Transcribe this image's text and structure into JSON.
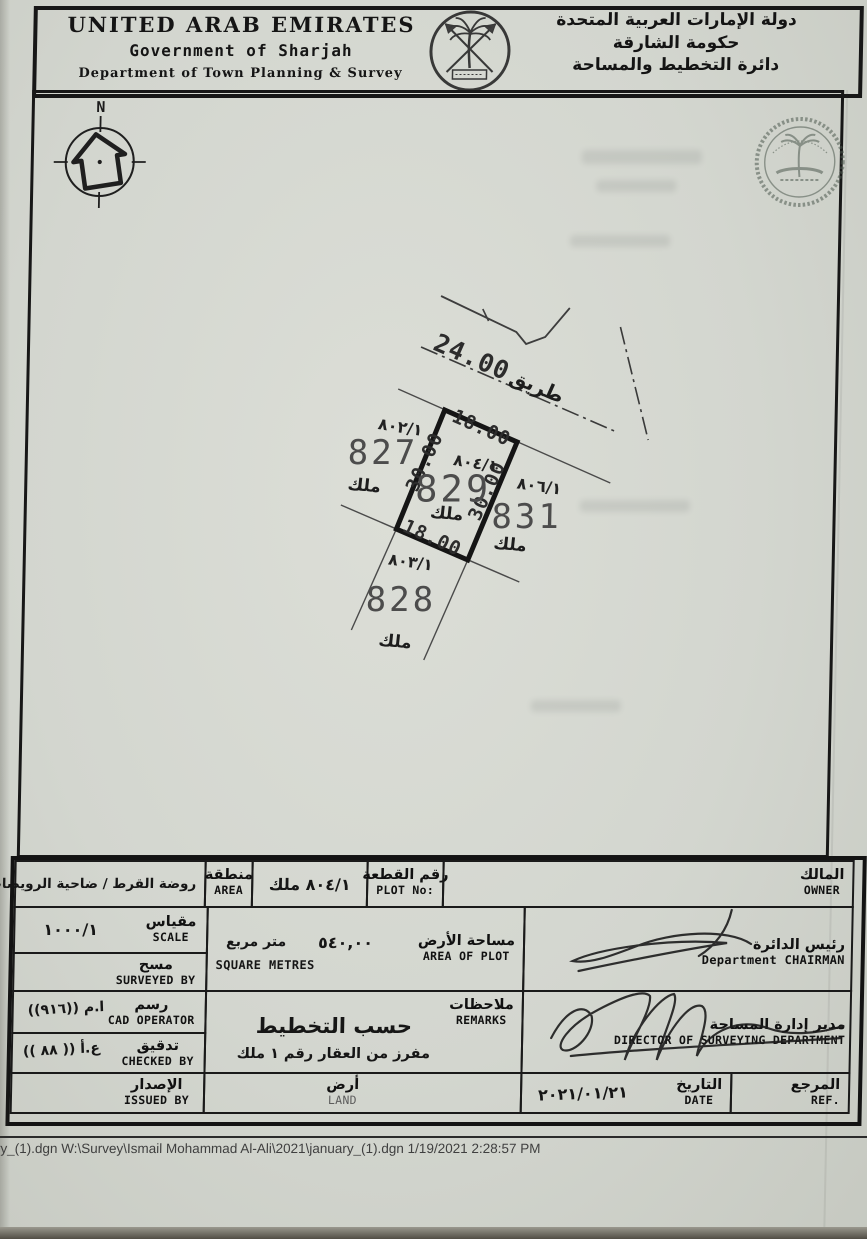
{
  "header": {
    "en1": "UNITED ARAB EMIRATES",
    "en2": "Government of Sharjah",
    "en3": "Department of Town Planning &  Survey",
    "ar1": "دولة الإمارات العربية المتحدة",
    "ar2": "حكومة الشارقة",
    "ar3": "دائرة التخطيط والمساحة"
  },
  "map": {
    "north": "N",
    "road_width": "24.00",
    "road_name": "طريق",
    "plot_center": {
      "parcel": "٨٠٤/١",
      "number": "829",
      "tenure": "ملك",
      "dim_top": "18.00",
      "dim_left": "30.00",
      "dim_right": "30.00",
      "dim_bottom": "18.00"
    },
    "plot_left": {
      "parcel": "٨٠٢/١",
      "number": "827",
      "tenure": "ملك"
    },
    "plot_right": {
      "parcel": "٨٠٦/١",
      "number": "831",
      "tenure": "ملك"
    },
    "plot_bottom": {
      "parcel": "٨٠٣/١",
      "number": "828",
      "tenure": "ملك"
    }
  },
  "table": {
    "area": {
      "ar": "منطقة",
      "en": "AREA",
      "value": "روضة القرط / ضاحية الرويضات"
    },
    "plot_no": {
      "ar": "رقم القطعة",
      "en": "PLOT No:",
      "value": "٨٠٤/١ ملك"
    },
    "owner": {
      "ar": "المالك",
      "en": "OWNER"
    },
    "scale": {
      "ar": "مقياس",
      "en": "SCALE",
      "value": "١٠٠٠/١"
    },
    "area_plot": {
      "ar": "مساحة الأرض",
      "en": "AREA OF PLOT",
      "value": "٥٤٠,٠٠",
      "unit_ar": "متر مربع",
      "unit_en": "SQUARE METRES"
    },
    "surveyed": {
      "ar": "مسح",
      "en": "SURVEYED BY"
    },
    "cad": {
      "ar": "رسم",
      "en": "CAD OPERATOR",
      "value": "ا.م ((٩١٦))"
    },
    "checked": {
      "ar": "تدقيق",
      "en": "CHECKED BY",
      "value": "ع.أ (( ٨٨ ))"
    },
    "remarks": {
      "ar": "ملاحظات",
      "en": "REMARKS",
      "line1": "حسب التخطيط",
      "line2": "مفرز من العقار رقم ١ ملك"
    },
    "issued": {
      "ar": "الإصدار",
      "en": "ISSUED BY"
    },
    "land": {
      "ar": "أرض",
      "en": "LAND"
    },
    "chairman": {
      "ar": "رئيس الدائرة",
      "en": "Department CHAIRMAN"
    },
    "director": {
      "ar": "مدير إدارة المساحة",
      "en": "DIRECTOR OF SURVEYING DEPARTMENT"
    },
    "date": {
      "ar": "التاريخ",
      "en": "DATE",
      "value": "٢٠٢١/٠١/٢١"
    },
    "ref": {
      "ar": "المرجع",
      "en": "REF."
    }
  },
  "footer": {
    "text": "uary_(1).dgn W:\\Survey\\Ismail Mohammad Al-Ali\\2021\\january_(1).dgn  1/19/2021  2:28:57 PM"
  }
}
